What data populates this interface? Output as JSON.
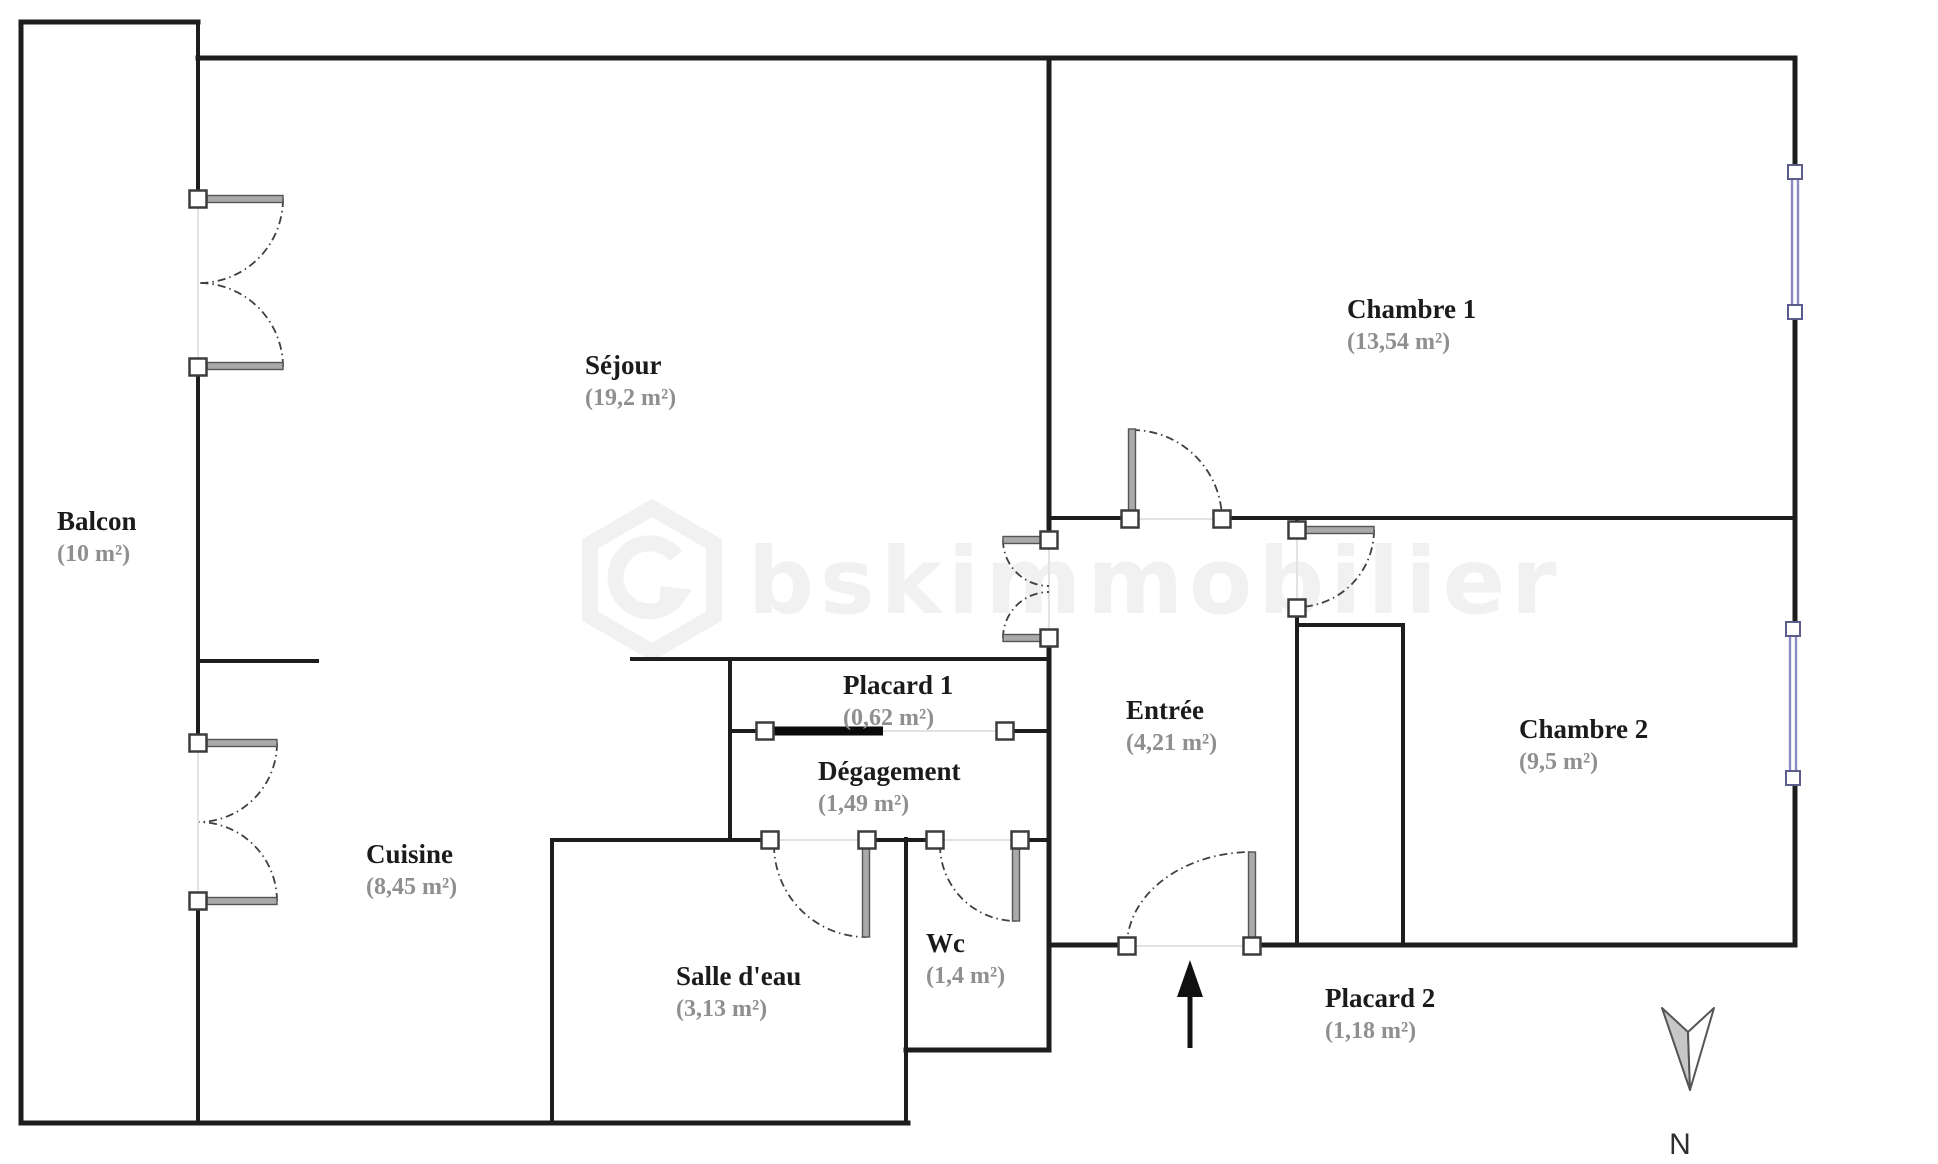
{
  "plan": {
    "watermark_text": "bskimmobilier",
    "compass_label": "N",
    "colors": {
      "wall": "#1d1d1d",
      "door_leaf": "#a8a8a8",
      "window_blue": "#8a8ac0",
      "area_text": "#8f8f8f",
      "watermark": "#f1f1f1"
    },
    "rooms": [
      {
        "id": "balcon",
        "name": "Balcon",
        "area": "(10 m²)"
      },
      {
        "id": "sejour",
        "name": "Séjour",
        "area": "(19,2 m²)"
      },
      {
        "id": "chambre1",
        "name": "Chambre 1",
        "area": "(13,54 m²)"
      },
      {
        "id": "entree",
        "name": "Entrée",
        "area": "(4,21 m²)"
      },
      {
        "id": "placard1",
        "name": "Placard 1",
        "area": "(0,62 m²)"
      },
      {
        "id": "degagement",
        "name": "Dégagement",
        "area": "(1,49 m²)"
      },
      {
        "id": "cuisine",
        "name": "Cuisine",
        "area": "(8,45 m²)"
      },
      {
        "id": "salledeau",
        "name": "Salle d'eau",
        "area": "(3,13 m²)"
      },
      {
        "id": "wc",
        "name": "Wc",
        "area": "(1,4 m²)"
      },
      {
        "id": "chambre2",
        "name": "Chambre 2",
        "area": "(9,5 m²)"
      },
      {
        "id": "placard2",
        "name": "Placard 2",
        "area": "(1,18 m²)"
      }
    ]
  }
}
